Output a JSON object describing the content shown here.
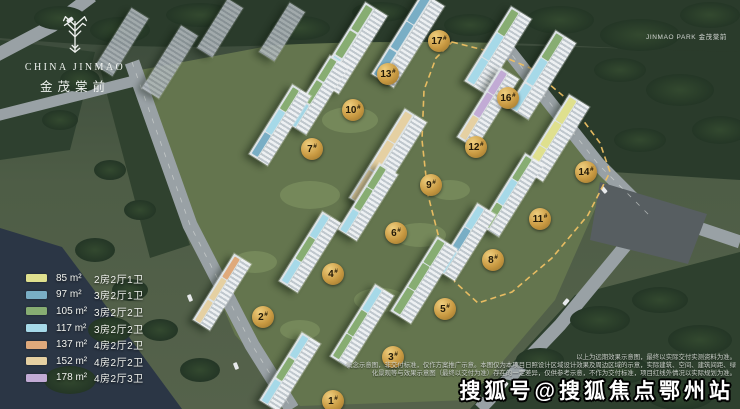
{
  "brand": {
    "logo_en": "CHINA JINMAO",
    "logo_cn": "金茂棠前",
    "corner_caption": "JINMAO PARK 金茂棠前"
  },
  "legend": {
    "items": [
      {
        "area": "85",
        "unit": "m²",
        "layout": "2房2厅1卫",
        "color": "#dfe08e"
      },
      {
        "area": "97",
        "unit": "m²",
        "layout": "3房2厅1卫",
        "color": "#79aec5"
      },
      {
        "area": "105",
        "unit": "m²",
        "layout": "3房2厅2卫",
        "color": "#87ad72"
      },
      {
        "area": "117",
        "unit": "m²",
        "layout": "3房2厅2卫",
        "color": "#a6d9e8"
      },
      {
        "area": "137",
        "unit": "m²",
        "layout": "4房2厅2卫",
        "color": "#dfa97b"
      },
      {
        "area": "152",
        "unit": "m²",
        "layout": "4房2厅2卫",
        "color": "#e5d0a2"
      },
      {
        "area": "178",
        "unit": "m²",
        "layout": "4房2厅3卫",
        "color": "#c2abd5"
      }
    ]
  },
  "site": {
    "tower_rotation_deg": 32,
    "badge_gold": "#c99a42",
    "boundary_gold": "#eec063",
    "badges": [
      {
        "label": "1#",
        "x": 333,
        "y": 401
      },
      {
        "label": "2#",
        "x": 263,
        "y": 317
      },
      {
        "label": "3#",
        "x": 393,
        "y": 357
      },
      {
        "label": "4#",
        "x": 333,
        "y": 274
      },
      {
        "label": "5#",
        "x": 445,
        "y": 309
      },
      {
        "label": "6#",
        "x": 396,
        "y": 233
      },
      {
        "label": "7#",
        "x": 312,
        "y": 149
      },
      {
        "label": "8#",
        "x": 493,
        "y": 260
      },
      {
        "label": "9#",
        "x": 431,
        "y": 185
      },
      {
        "label": "10#",
        "x": 353,
        "y": 110
      },
      {
        "label": "11#",
        "x": 540,
        "y": 219
      },
      {
        "label": "12#",
        "x": 476,
        "y": 147
      },
      {
        "label": "13#",
        "x": 388,
        "y": 74
      },
      {
        "label": "14#",
        "x": 586,
        "y": 172
      },
      {
        "label": "16#",
        "x": 508,
        "y": 98
      },
      {
        "label": "17#",
        "x": 439,
        "y": 41
      }
    ],
    "towers": [
      {
        "x": 352,
        "y": 48,
        "w": 26,
        "h": 92,
        "tiles": [
          105,
          105,
          117
        ]
      },
      {
        "x": 408,
        "y": 40,
        "w": 26,
        "h": 96,
        "tiles": [
          97,
          97,
          97
        ]
      },
      {
        "x": 498,
        "y": 50,
        "w": 24,
        "h": 88,
        "tiles": [
          105,
          117,
          117
        ]
      },
      {
        "x": 542,
        "y": 75,
        "w": 24,
        "h": 90,
        "tiles": [
          105,
          117,
          117
        ]
      },
      {
        "x": 318,
        "y": 95,
        "w": 22,
        "h": 80,
        "tiles": [
          105,
          105,
          117
        ]
      },
      {
        "x": 488,
        "y": 108,
        "w": 22,
        "h": 82,
        "tiles": [
          178,
          178,
          152
        ]
      },
      {
        "x": 280,
        "y": 125,
        "w": 22,
        "h": 82,
        "tiles": [
          105,
          117,
          97
        ]
      },
      {
        "x": 556,
        "y": 138,
        "w": 24,
        "h": 88,
        "tiles": [
          85,
          85,
          85
        ]
      },
      {
        "x": 388,
        "y": 160,
        "w": 26,
        "h": 105,
        "tiles": [
          152,
          152,
          152
        ]
      },
      {
        "x": 512,
        "y": 195,
        "w": 22,
        "h": 85,
        "tiles": [
          105,
          117,
          105
        ]
      },
      {
        "x": 368,
        "y": 202,
        "w": 22,
        "h": 78,
        "tiles": [
          105,
          105,
          117
        ]
      },
      {
        "x": 466,
        "y": 242,
        "w": 22,
        "h": 78,
        "tiles": [
          117,
          97,
          117
        ]
      },
      {
        "x": 310,
        "y": 252,
        "w": 22,
        "h": 82,
        "tiles": [
          117,
          105,
          117
        ]
      },
      {
        "x": 424,
        "y": 280,
        "w": 24,
        "h": 88,
        "tiles": [
          105,
          105,
          105
        ]
      },
      {
        "x": 222,
        "y": 292,
        "w": 20,
        "h": 78,
        "tiles": [
          137,
          152,
          152
        ]
      },
      {
        "x": 362,
        "y": 326,
        "w": 22,
        "h": 85,
        "tiles": [
          117,
          105,
          105
        ]
      },
      {
        "x": 290,
        "y": 372,
        "w": 22,
        "h": 80,
        "tiles": [
          117,
          105,
          117
        ]
      },
      {
        "x": 122,
        "y": 42,
        "w": 20,
        "h": 68,
        "ctx": true
      },
      {
        "x": 170,
        "y": 62,
        "w": 20,
        "h": 74,
        "ctx": true
      },
      {
        "x": 220,
        "y": 28,
        "w": 18,
        "h": 58,
        "ctx": true
      },
      {
        "x": 282,
        "y": 32,
        "w": 18,
        "h": 58,
        "ctx": true
      }
    ]
  },
  "disclaimer": {
    "lines": [
      "以上为远期效果示意图，最终以实际交付实测资料为准。",
      "概念示意图，非交付标准，仅作方案推广示意。本图仅为本项目日照设计区域设计效果及周边区域的示意，实际建筑、空间、建筑间距、绿",
      "化景观等与效果示意图（最终以交付为准）存在的一定差异，仅供参考示意，不作为交付标准，项目红线外情况以实际规划为准。"
    ]
  },
  "watermark": "搜狐号@搜狐焦点鄂州站"
}
